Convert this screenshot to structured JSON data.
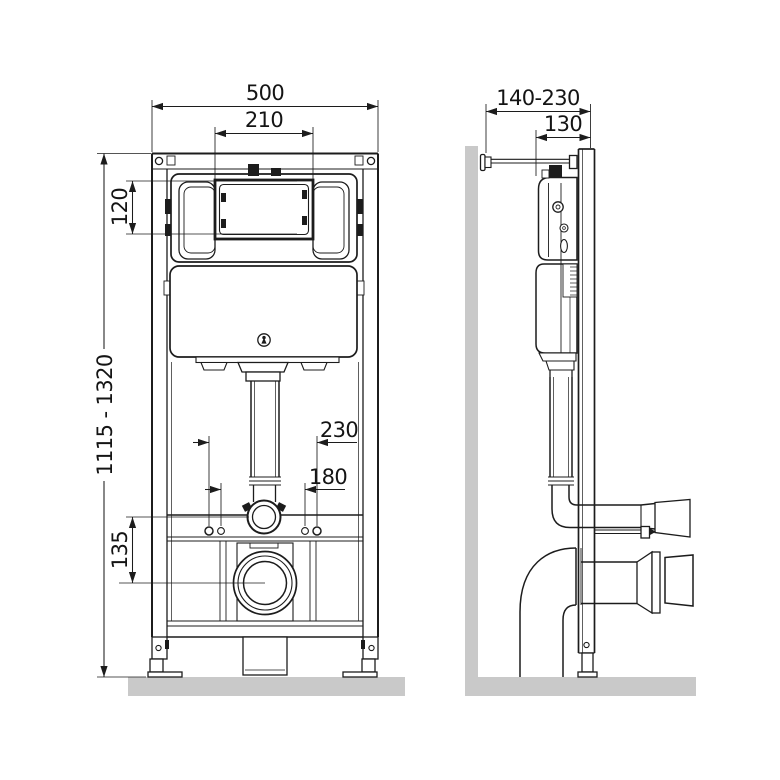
{
  "colors": {
    "background": "#ffffff",
    "line": "#1c1c1c",
    "wall": "#c9c9c9",
    "floor": "#c9c9c9"
  },
  "views": {
    "front": {
      "dimensions": [
        {
          "id": "frame-width",
          "label": "500"
        },
        {
          "id": "flush-opening-width",
          "label": "210"
        },
        {
          "id": "flush-opening-height",
          "label": "120"
        },
        {
          "id": "frame-height-range",
          "label": "1115 - 1320"
        },
        {
          "id": "outer-fixing-spacing",
          "label": "230"
        },
        {
          "id": "inner-fixing-spacing",
          "label": "180"
        },
        {
          "id": "outlet-drop",
          "label": "135"
        }
      ]
    },
    "side": {
      "dimensions": [
        {
          "id": "depth-range",
          "label": "140-230"
        },
        {
          "id": "frame-depth",
          "label": "130"
        }
      ]
    }
  }
}
